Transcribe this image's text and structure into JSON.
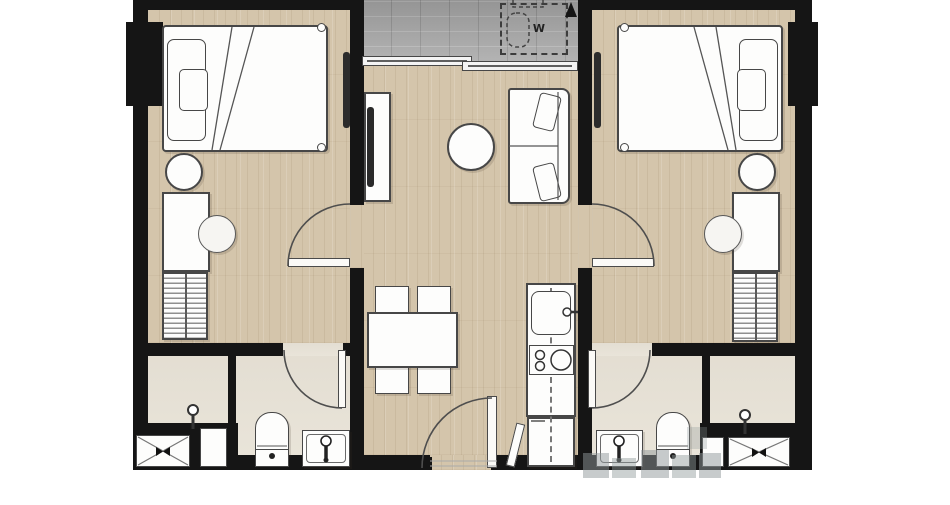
{
  "floor_plan": {
    "washer_label": "W",
    "colors": {
      "background": "#ffffff",
      "wall": "#151515",
      "wood_floor": "#d4c5ab",
      "balcony_floor": "#a9a9a9",
      "bathroom_floor": "#e9e4d9",
      "furniture_fill": "#fdfdfc",
      "furniture_outline": "#474747",
      "watermark": "#8f9899"
    }
  }
}
